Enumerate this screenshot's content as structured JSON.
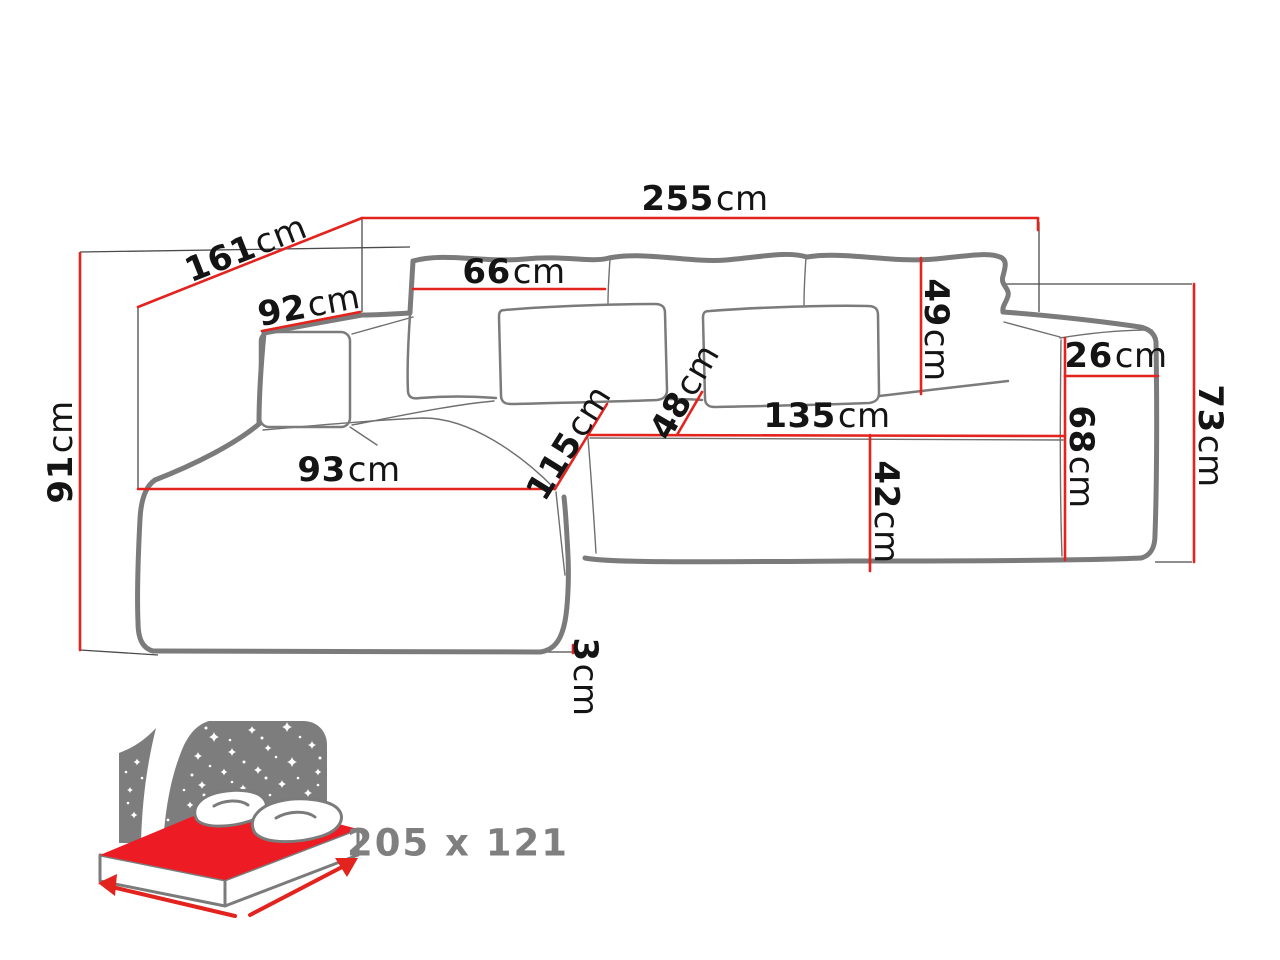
{
  "diagram": {
    "type": "corner-sofa dimension drawing",
    "unit_default": "cm"
  },
  "colors": {
    "dimension_red": "#e2231e",
    "mattress_red": "#ed1c24",
    "outline_gray": "#7b7b7b",
    "reference_gray": "#4a4a4a",
    "icon_gray": "#7d7d7d",
    "label_black": "#141414",
    "sleeping_text_gray": "#7f7f7f"
  },
  "dims": {
    "total_width": {
      "value": "255",
      "unit": "cm"
    },
    "total_depth_diagonal": {
      "value": "161",
      "unit": "cm"
    },
    "left_armrest_length": {
      "value": "92",
      "unit": "cm"
    },
    "back_cushion_width": {
      "value": "66",
      "unit": "cm"
    },
    "overall_height": {
      "value": "91",
      "unit": "cm"
    },
    "chaise_width": {
      "value": "93",
      "unit": "cm"
    },
    "chaise_length": {
      "value": "115",
      "unit": "cm"
    },
    "corner_seat_width": {
      "value": "48",
      "unit": "cm"
    },
    "seat_length": {
      "value": "135",
      "unit": "cm"
    },
    "seat_front_height": {
      "value": "42",
      "unit": "cm"
    },
    "back_cushion_height": {
      "value": "49",
      "unit": "cm"
    },
    "right_armrest_width": {
      "value": "26",
      "unit": "cm"
    },
    "right_armrest_height": {
      "value": "68",
      "unit": "cm"
    },
    "right_side_height": {
      "value": "73",
      "unit": "cm"
    },
    "leg_height": {
      "value": "3",
      "unit": "cm"
    }
  },
  "sleeping_area": {
    "size_label": "205 x 121"
  }
}
